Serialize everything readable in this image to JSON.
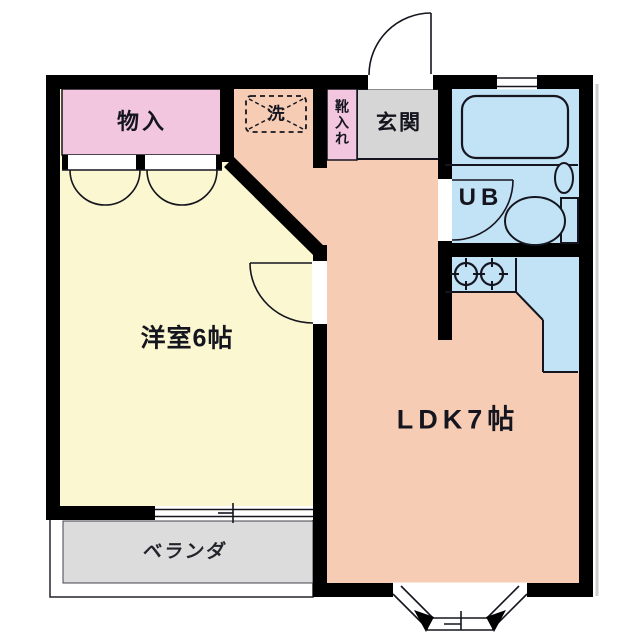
{
  "colors": {
    "wall": "#000000",
    "room_yellow": "#fbf7d0",
    "ldk_salmon": "#f6cdb4",
    "water_blue": "#c2e3f5",
    "closet_pink": "#f2c6de",
    "entry_gray": "#d6d6d6",
    "veranda_gray": "#dcdcdc",
    "line": "#15151f",
    "text": "#15151f"
  },
  "rooms": {
    "storage": "物入",
    "washer": "洗",
    "shoe_cabinet": "靴入れ",
    "entrance": "玄関",
    "unit_bath": "UB",
    "western_room": "洋室6帖",
    "ldk": "LDK7帖",
    "veranda": "ベランダ"
  }
}
